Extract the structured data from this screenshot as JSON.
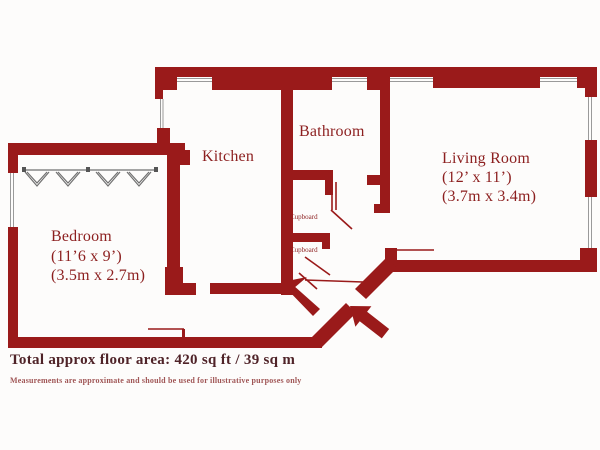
{
  "plan": {
    "rooms": {
      "kitchen": {
        "label": "Kitchen"
      },
      "bathroom": {
        "label": "Bathroom"
      },
      "living_room": {
        "label": "Living Room",
        "dims_imperial": "(12’ x 11’)",
        "dims_metric": "(3.7m x 3.4m)"
      },
      "bedroom": {
        "label": "Bedroom",
        "dims_imperial": "(11’6 x 9’)",
        "dims_metric": "(3.5m x 2.7m)"
      },
      "cupboard_top": {
        "label": "Cupboard"
      },
      "cupboard_bottom": {
        "label": "Cupboard"
      }
    },
    "icons": {
      "entrance_arrow": "arrow-up-left-entrance",
      "wardrobe": "bifold-wardrobe-doors"
    },
    "footer": {
      "total_area": "Total approx floor area: 420 sq ft / 39 sq m",
      "disclaimer": "Measurements are approximate and should be used for illustrative purposes only"
    },
    "colors": {
      "wall": "#9a1a1a",
      "label": "#8c1f1f",
      "title": "#4f2328",
      "disclaimer": "#a05656",
      "window_line": "#9a9a9a",
      "wardrobe_line": "#6f6f6f"
    }
  }
}
